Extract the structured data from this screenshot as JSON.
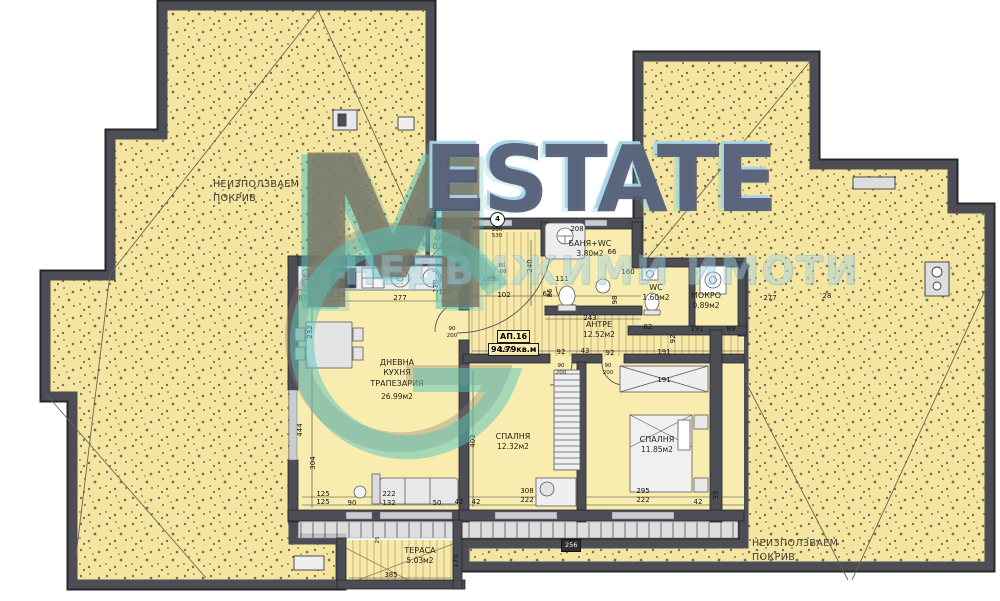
{
  "watermark": {
    "monogram": "M",
    "brand": "ESTATE",
    "subtitle": "НЕДВИЖИМИ ИМОТИ",
    "accent_teal": "#55c3bb",
    "brand_dark": "#565c78"
  },
  "apartment": {
    "id": "АП.16",
    "area": "94.79кв.м"
  },
  "rooms": {
    "roof_left": {
      "l1": "НЕИЗПОЛЗВАЕМ",
      "l2": "ПОКРИВ"
    },
    "roof_right": {
      "l1": "НЕИЗПОЛЗВАЕМ",
      "l2": "ПОКРИВ"
    },
    "storage": {
      "name": "СКЛАД",
      "area": "0.97м2"
    },
    "bath": {
      "name": "БАНЯ+WC",
      "area": "3.80м2"
    },
    "wc": {
      "name": "WC",
      "area": "1.60м2"
    },
    "laundry": {
      "name": "МОКРО",
      "area": "0.89м2"
    },
    "hall": {
      "name": "АНТРЕ",
      "area": "12.52м2"
    },
    "living": {
      "l1": "ДНЕВНА",
      "l2": "КУХНЯ",
      "l3": "ТРАПЕЗАРИЯ",
      "area": "26.99м2"
    },
    "bedroom1": {
      "name": "СПАЛНЯ",
      "area": "12.32м2"
    },
    "bedroom2": {
      "name": "СПАЛНЯ",
      "area": "11.85м2"
    },
    "terrace": {
      "name": "ТЕРАСА",
      "area": "5.03м2"
    }
  },
  "markers": {
    "entry_circle": "4",
    "level": "256"
  },
  "colors": {
    "roof_fill": "#f4e5a1",
    "floor_fill": "#f8ecae",
    "wall": "#4d4d56"
  },
  "dimensions": [
    {
      "t": "85",
      "x": 303,
      "y": 298
    },
    {
      "t": "30",
      "x": 329,
      "y": 295
    },
    {
      "t": "28",
      "x": 341,
      "y": 295
    },
    {
      "t": "277",
      "x": 400,
      "y": 298
    },
    {
      "t": "120",
      "x": 436,
      "y": 286,
      "v": 1
    },
    {
      "t": "232",
      "x": 310,
      "y": 332,
      "v": 1
    },
    {
      "t": "444",
      "x": 300,
      "y": 430,
      "v": 1
    },
    {
      "t": "304",
      "x": 313,
      "y": 463,
      "v": 1
    },
    {
      "t": "125",
      "x": 323,
      "y": 494
    },
    {
      "t": "125",
      "x": 323,
      "y": 502
    },
    {
      "t": "90",
      "x": 352,
      "y": 503
    },
    {
      "t": "222",
      "x": 389,
      "y": 494
    },
    {
      "t": "132",
      "x": 389,
      "y": 503
    },
    {
      "t": "50",
      "x": 437,
      "y": 503
    },
    {
      "t": "42",
      "x": 459,
      "y": 502
    },
    {
      "t": "119",
      "x": 445,
      "y": 292
    },
    {
      "t": "103",
      "x": 469,
      "y": 287,
      "v": 1
    },
    {
      "t": "102",
      "x": 504,
      "y": 295
    },
    {
      "t": "62",
      "x": 547,
      "y": 294
    },
    {
      "t": "189",
      "x": 489,
      "y": 279
    },
    {
      "t": "240",
      "x": 530,
      "y": 266,
      "v": 1
    },
    {
      "t": "80",
      "x": 502,
      "y": 266,
      "s": 1
    },
    {
      "t": "60",
      "x": 503,
      "y": 272,
      "s": 1
    },
    {
      "t": "208",
      "x": 577,
      "y": 229
    },
    {
      "t": "66",
      "x": 612,
      "y": 252
    },
    {
      "t": "111",
      "x": 562,
      "y": 279
    },
    {
      "t": "86",
      "x": 550,
      "y": 293,
      "v": 1
    },
    {
      "t": "243",
      "x": 590,
      "y": 318
    },
    {
      "t": "160",
      "x": 628,
      "y": 272
    },
    {
      "t": "98",
      "x": 615,
      "y": 300,
      "v": 1
    },
    {
      "t": "82",
      "x": 648,
      "y": 327
    },
    {
      "t": "92",
      "x": 673,
      "y": 339,
      "v": 1
    },
    {
      "t": "191",
      "x": 697,
      "y": 329
    },
    {
      "t": "89",
      "x": 731,
      "y": 329
    },
    {
      "t": "277",
      "x": 770,
      "y": 298
    },
    {
      "t": "28",
      "x": 827,
      "y": 296
    },
    {
      "t": "197",
      "x": 506,
      "y": 350
    },
    {
      "t": "92",
      "x": 561,
      "y": 352
    },
    {
      "t": "43",
      "x": 585,
      "y": 351
    },
    {
      "t": "92",
      "x": 610,
      "y": 353
    },
    {
      "t": "191",
      "x": 664,
      "y": 352
    },
    {
      "t": "191",
      "x": 664,
      "y": 380
    },
    {
      "t": "402",
      "x": 473,
      "y": 441,
      "v": 1
    },
    {
      "t": "308",
      "x": 527,
      "y": 491
    },
    {
      "t": "222",
      "x": 527,
      "y": 500
    },
    {
      "t": "42",
      "x": 476,
      "y": 502
    },
    {
      "t": "295",
      "x": 643,
      "y": 491
    },
    {
      "t": "222",
      "x": 643,
      "y": 500
    },
    {
      "t": "42",
      "x": 698,
      "y": 502
    },
    {
      "t": "35",
      "x": 716,
      "y": 495,
      "v": 1
    },
    {
      "t": "385",
      "x": 391,
      "y": 575
    },
    {
      "t": "175",
      "x": 456,
      "y": 561,
      "v": 1
    },
    {
      "t": "25",
      "x": 378,
      "y": 540,
      "v": 1,
      "s": 1
    },
    {
      "t": "260",
      "x": 497,
      "y": 230,
      "s": 1
    },
    {
      "t": "530",
      "x": 497,
      "y": 236,
      "s": 1
    },
    {
      "t": "90",
      "x": 452,
      "y": 329,
      "s": 1
    },
    {
      "t": "200",
      "x": 452,
      "y": 336,
      "s": 1
    },
    {
      "t": "90",
      "x": 561,
      "y": 366,
      "s": 1
    },
    {
      "t": "200",
      "x": 561,
      "y": 373,
      "s": 1
    },
    {
      "t": "90",
      "x": 608,
      "y": 366,
      "s": 1
    },
    {
      "t": "200",
      "x": 608,
      "y": 373,
      "s": 1
    }
  ]
}
